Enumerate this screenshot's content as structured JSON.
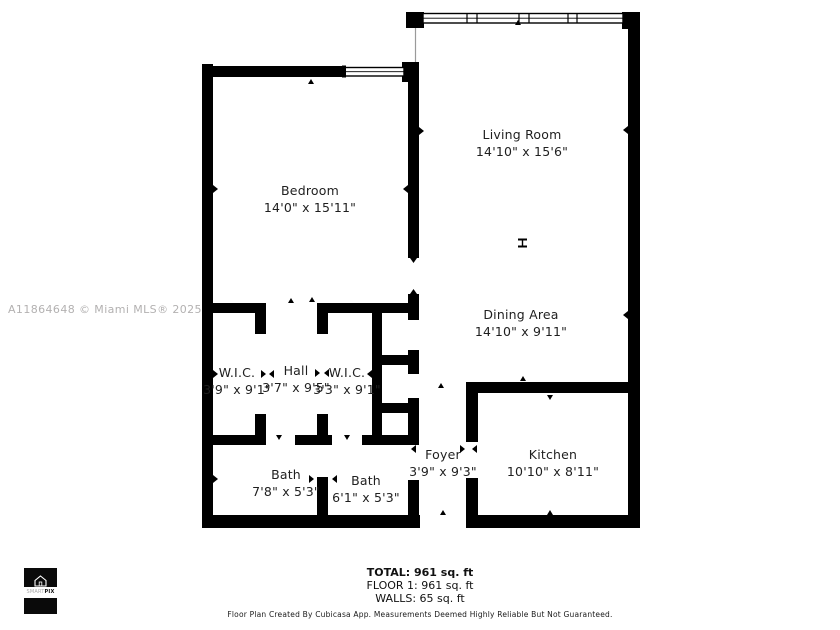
{
  "watermark": "A11864648 © Miami MLS® 2025",
  "rooms": [
    {
      "name": "Living Room",
      "dims": "14'10\" x 15'6\""
    },
    {
      "name": "Bedroom",
      "dims": "14'0\" x 15'11\""
    },
    {
      "name": "Dining Area",
      "dims": "14'10\" x 9'11\""
    },
    {
      "name": "W.I.C.",
      "dims": "3'9\" x 9'1\""
    },
    {
      "name": "Hall",
      "dims": "3'7\" x 9'5\""
    },
    {
      "name": "W.I.C.",
      "dims": "3'3\" x 9'1\""
    },
    {
      "name": "Foyer",
      "dims": "3'9\" x 9'3\""
    },
    {
      "name": "Kitchen",
      "dims": "10'10\" x 8'11\""
    },
    {
      "name": "Bath",
      "dims": "7'8\" x 5'3\""
    },
    {
      "name": "Bath",
      "dims": "6'1\" x 5'3\""
    }
  ],
  "summary": {
    "total": "TOTAL: 961 sq. ft",
    "floor": "FLOOR 1: 961 sq. ft",
    "walls": "WALLS: 65 sq. ft"
  },
  "disclaimer": "Floor Plan Created By Cubicasa App. Measurements Deemed Highly Reliable But Not Guaranteed.",
  "logo": {
    "brand_prefix": "SMART",
    "brand_suffix": "PIX"
  },
  "colors": {
    "wall": "#000000",
    "watermark": "#b3b1b1",
    "label_text": "#1f1f1f",
    "logo_bg": "#0a0a0a"
  }
}
